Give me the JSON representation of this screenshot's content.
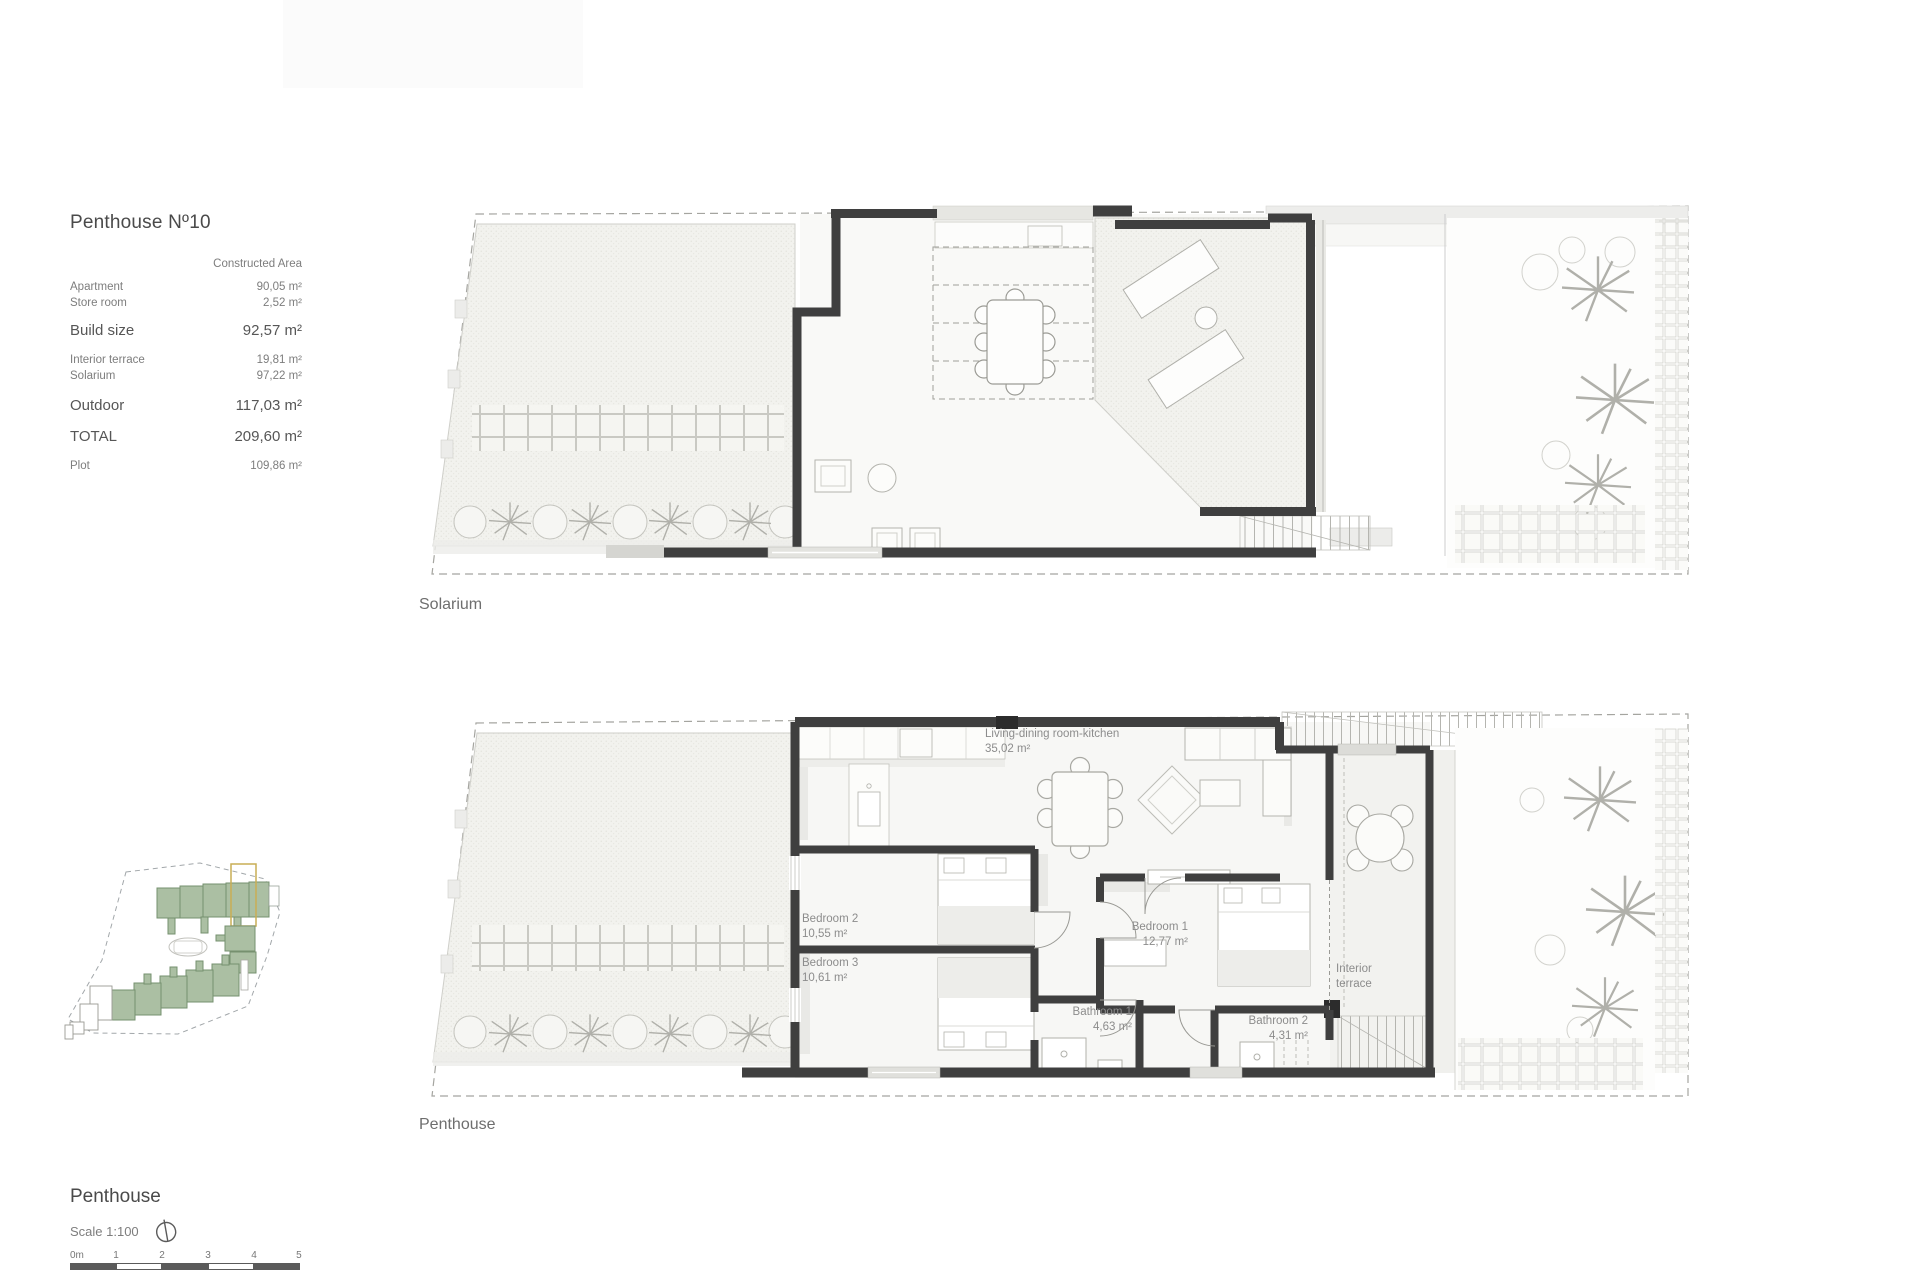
{
  "document": {
    "info_panel": {
      "title": "Penthouse Nº10",
      "table": {
        "header": "Constructed Area",
        "rows": [
          {
            "label": "Apartment",
            "value": "90,05 m²"
          },
          {
            "label": "Store room",
            "value": "2,52 m²"
          },
          {
            "label": "Build size",
            "value": "92,57 m²"
          },
          {
            "label": "Interior terrace",
            "value": "19,81 m²"
          },
          {
            "label": "Solarium",
            "value": "97,22 m²"
          },
          {
            "label": "Outdoor",
            "value": "117,03 m²"
          },
          {
            "label": "TOTAL",
            "value": "209,60 m²"
          },
          {
            "label": "Plot",
            "value": "109,86 m²"
          }
        ]
      }
    },
    "solarium_plan": {
      "caption": "Solarium"
    },
    "penthouse_plan": {
      "caption": "Penthouse",
      "room_labels": {
        "living": {
          "name": "Living-dining room-kitchen",
          "area": "35,02 m²"
        },
        "bedroom2": {
          "name": "Bedroom 2",
          "area": "10,55 m²"
        },
        "bedroom3": {
          "name": "Bedroom 3",
          "area": "10,61 m²"
        },
        "bedroom1": {
          "name": "Bedroom 1",
          "area": "12,77 m²"
        },
        "bathroom1": {
          "name": "Bathroom 1",
          "area": "4,63 m²"
        },
        "bathroom2": {
          "name": "Bathroom 2",
          "area": "4,31 m²"
        },
        "interior_terrace": {
          "name": "Interior terrace"
        }
      }
    },
    "footer": {
      "plan_title": "Penthouse",
      "scale_label": "Scale 1:100",
      "scale_bar_labels": [
        "0m",
        "1",
        "2",
        "3",
        "4",
        "5"
      ]
    },
    "colors": {
      "wall": "#3f3f3f",
      "hatch_fill": "#f2f2ee",
      "label_text": "#8c8c8c",
      "title_text": "#4a4a4a",
      "site_map_building": "#abbfa3",
      "site_map_highlight": "#c9ad55",
      "scale_bar_dark": "#5b5b5b"
    }
  }
}
